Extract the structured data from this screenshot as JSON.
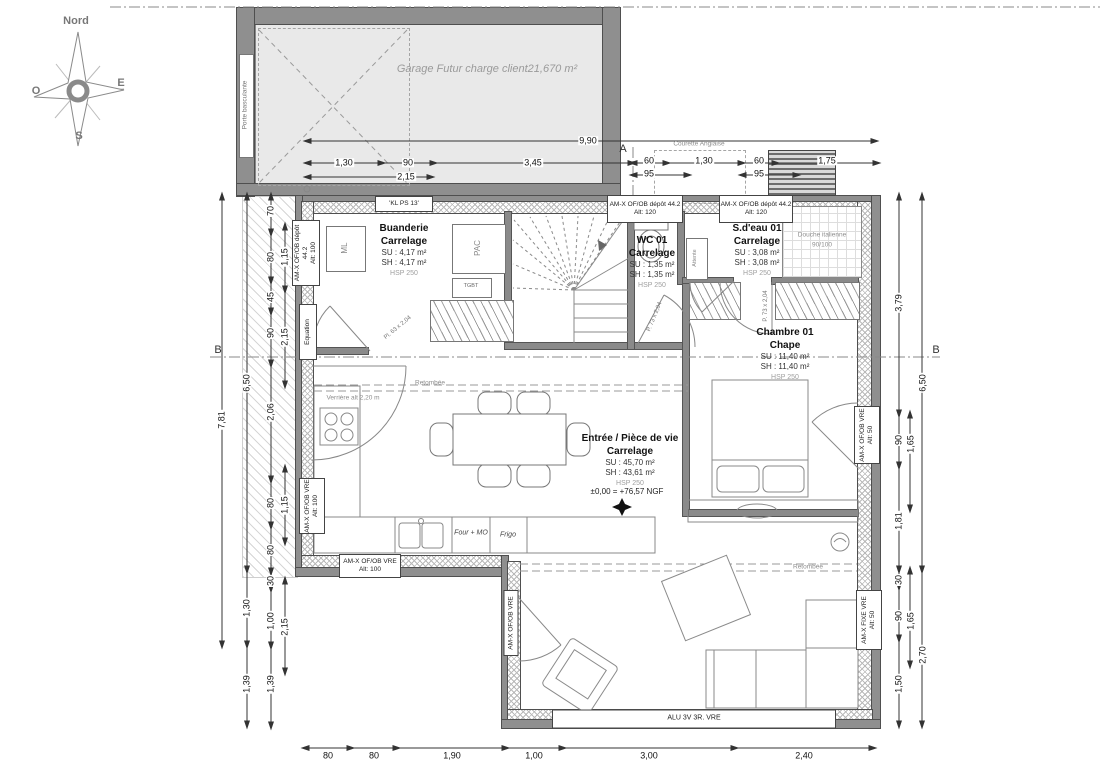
{
  "compass": {
    "north": "Nord",
    "west": "O",
    "east": "E",
    "south": "S"
  },
  "garage": {
    "label": "Garage Futur charge client21,670 m²",
    "door": "Porte basculante"
  },
  "site": {
    "courette": "Courette Anglaise"
  },
  "rooms": {
    "buanderie": {
      "name": "Buanderie",
      "finish": "Carrelage",
      "su": "SU : 4,17 m²",
      "sh": "SH : 4,17 m²",
      "hsp": "HSP 250"
    },
    "wc": {
      "name": "WC 01",
      "finish": "Carrelage",
      "su": "SU : 1,35 m²",
      "sh": "SH : 1,35 m²",
      "hsp": "HSP 250"
    },
    "sdeau": {
      "name": "S.d'eau 01",
      "finish": "Carrelage",
      "su": "SU : 3,08 m²",
      "sh": "SH : 3,08 m²",
      "hsp": "HSP 250"
    },
    "chambre": {
      "name": "Chambre 01",
      "finish": "Chape",
      "su": "SU : 11,40 m²",
      "sh": "SH : 11,40 m²",
      "hsp": "HSP 250"
    },
    "sejour": {
      "name": "Entrée / Pièce de vie",
      "finish": "Carrelage",
      "su": "SU : 45,70 m²",
      "sh": "SH : 43,61 m²",
      "hsp": "HSP 250",
      "level": "±0,00 = +76,57 NGF"
    }
  },
  "equipment": {
    "ml": "ML",
    "pac": "PAC",
    "tgbt": "TGBT",
    "attente": "Attente",
    "douche1": "Douche italienne",
    "douche2": "90/100",
    "four": "Four + MO",
    "frigo": "Frigo",
    "verriere": "Verrière alt 2,20 m",
    "retombee": "Retombée"
  },
  "doors": {
    "d1": "Pl. 63 x 2,04",
    "d2": "P. 73 x 2,04",
    "d3": "P. 73 x 2,04"
  },
  "openings": {
    "kl": "'KL PS 13'",
    "dep": "AM-X OF/OB dépôt 44.2",
    "alt120": "Alt: 120",
    "alt100": "Alt: 100",
    "alt50": "Alt: 50",
    "equation": "Equation",
    "vre": "AM-X OF/OB VRE",
    "fixe": "AM-X FIXE VRE",
    "bay": "ALU 3V 3R. VRE"
  },
  "dims": {
    "overall_top": "9,90",
    "g1": "1,30",
    "g2": "90",
    "g3": "3,45",
    "g4": "2,15",
    "r1": "60",
    "r2": "95",
    "r3": "1,30",
    "r4": "60",
    "r5": "95",
    "r6": "1,75",
    "l_outer": "7,81",
    "l_mid": [
      "6,50",
      "1,30",
      "1,39"
    ],
    "l_in": [
      "70",
      "80",
      "45",
      "90",
      "2,06",
      "80",
      "80",
      "30",
      "1,00",
      "1,39"
    ],
    "l_pair": [
      "1,15",
      "2,15",
      "1,15",
      "2,15"
    ],
    "rt_in": [
      "3,79",
      "90",
      "1,81",
      "30",
      "90",
      "1,50"
    ],
    "rt_pair": [
      "1,65",
      "1,65"
    ],
    "rt_out": [
      "6,50",
      "2,70"
    ],
    "bottom": [
      "80",
      "80",
      "1,90",
      "1,00",
      "3,00",
      "2,40"
    ],
    "section_a": "A",
    "section_b": "B"
  }
}
